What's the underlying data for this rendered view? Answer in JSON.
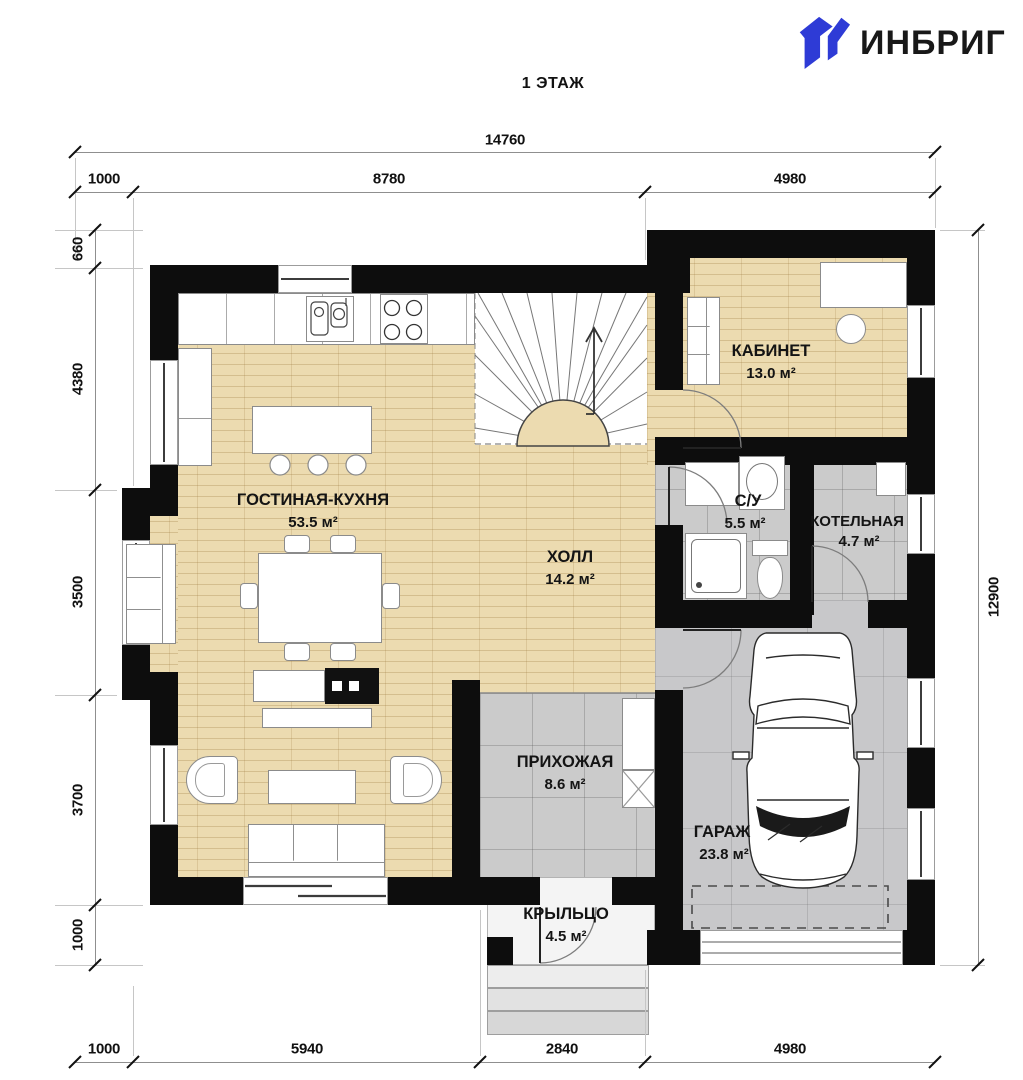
{
  "brand": {
    "name": "ИНБРИГ",
    "accent_color": "#2e3bd6"
  },
  "title": "1 ЭТАЖ",
  "rooms": [
    {
      "name": "ГОСТИНАЯ-КУХНЯ",
      "area": "53.5 м²"
    },
    {
      "name": "ХОЛЛ",
      "area": "14.2 м²"
    },
    {
      "name": "КАБИНЕТ",
      "area": "13.0 м²"
    },
    {
      "name": "С/У",
      "area": "5.5 м²"
    },
    {
      "name": "КОТЕЛЬНАЯ",
      "area": "4.7 м²"
    },
    {
      "name": "ПРИХОЖАЯ",
      "area": "8.6 м²"
    },
    {
      "name": "ГАРАЖ",
      "area": "23.8 м²"
    },
    {
      "name": "КРЫЛЬЦО",
      "area": "4.5 м²"
    }
  ],
  "dimensions": {
    "top_total": "14760",
    "top": [
      "1000",
      "8780",
      "4980"
    ],
    "bottom": [
      "1000",
      "5940",
      "2840",
      "4980"
    ],
    "left": [
      "660",
      "4380",
      "3500",
      "3700",
      "1000"
    ],
    "right_total": "12900"
  }
}
